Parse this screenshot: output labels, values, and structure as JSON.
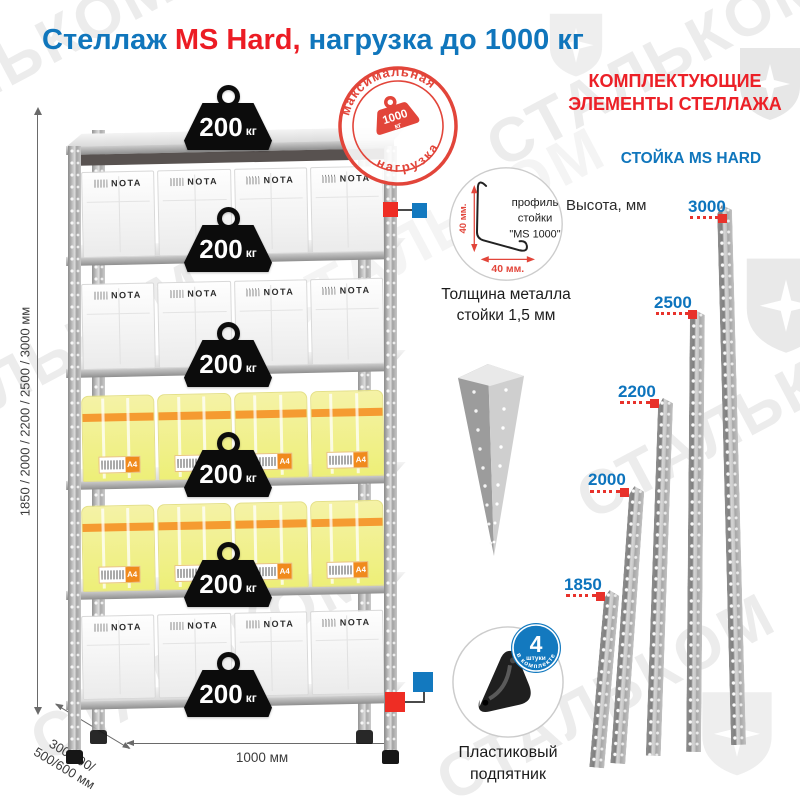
{
  "title": {
    "prefix": "Стеллаж",
    "model": "MS Hard,",
    "suffix": "нагрузка до 1000 кг"
  },
  "watermark": {
    "brand": "СТАЛЬКОМ"
  },
  "colors": {
    "blue": "#1076bc",
    "red": "#ec1c24",
    "stamp_red": "#e2453a",
    "badge_blue": "#1379bf"
  },
  "shelf_unit": {
    "badge_value": "200",
    "badge_unit": "кг",
    "box_brand": "NOTA",
    "paper_label": "A4",
    "stamp": {
      "arc_top": "максимальная",
      "arc_bottom": "нагрузка",
      "weight_value": "1000",
      "weight_unit": "кг"
    },
    "dimensions": {
      "height": "1850 / 2000 / 2200 / 2500 / 3000 мм",
      "depth_line1": "300/400/",
      "depth_line2": "500/600 мм",
      "width": "1000 мм"
    }
  },
  "profile_detail": {
    "dim_vertical": "40 мм.",
    "dim_horizontal": "40 мм.",
    "label_line1": "профиль",
    "label_line2": "стойки",
    "label_line3": "\"MS 1000\"",
    "caption_line1": "Толщина металла",
    "caption_line2": "стойки 1,5 мм"
  },
  "foot_detail": {
    "badge_number": "4",
    "badge_word": "штуки",
    "badge_arc": "в комплекте",
    "caption_line1": "Пластиковый",
    "caption_line2": "подпятник"
  },
  "components": {
    "heading_line1": "КОМПЛЕКТУЮЩИЕ",
    "heading_line2": "ЭЛЕМЕНТЫ СТЕЛЛАЖА",
    "subheading": "СТОЙКА MS HARD",
    "height_label": "Высота, мм",
    "posts": [
      {
        "height": "1850"
      },
      {
        "height": "2000"
      },
      {
        "height": "2200"
      },
      {
        "height": "2500"
      },
      {
        "height": "3000"
      }
    ]
  }
}
